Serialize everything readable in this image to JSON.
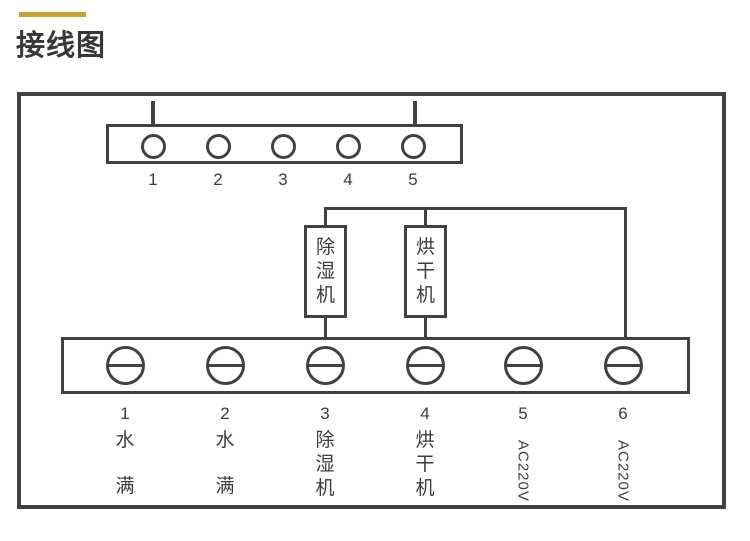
{
  "header": {
    "title": "接线图"
  },
  "colors": {
    "accent_bar": "#c5a035",
    "line": "#414141",
    "text": "#3c3c3c",
    "background": "#ffffff"
  },
  "top_terminal_strip": {
    "labels": [
      "1",
      "2",
      "3",
      "4",
      "5"
    ],
    "pins_above_terminals": [
      "1",
      "5"
    ]
  },
  "devices": {
    "dehumidifier": {
      "label": "除湿机",
      "chars": [
        "除",
        "湿",
        "机"
      ]
    },
    "dryer": {
      "label": "烘干机",
      "chars": [
        "烘",
        "干",
        "机"
      ]
    }
  },
  "bottom_terminal_strip": {
    "terminals": [
      {
        "number": "1",
        "label": "水满",
        "chars": [
          "水",
          "满"
        ]
      },
      {
        "number": "2",
        "label": "水满",
        "chars": [
          "水",
          "满"
        ]
      },
      {
        "number": "3",
        "label": "除湿机",
        "chars": [
          "除",
          "湿",
          "机"
        ]
      },
      {
        "number": "4",
        "label": "烘干机",
        "chars": [
          "烘",
          "干",
          "机"
        ]
      },
      {
        "number": "5",
        "label": "AC220V"
      },
      {
        "number": "6",
        "label": "AC220V"
      }
    ]
  }
}
